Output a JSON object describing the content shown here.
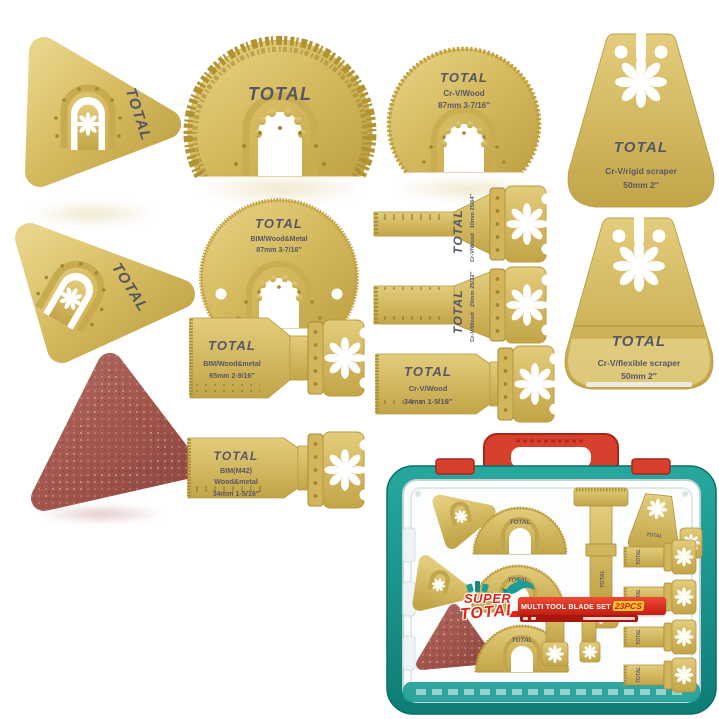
{
  "brand": "TOTAL",
  "background": "#ffffff",
  "palette": {
    "gold": "#d7bc62",
    "gold_dark": "#b89a3e",
    "logo_gray": "#565665",
    "sand_red": "#a3564e",
    "case_teal": "#1b9c94",
    "case_red": "#d8402e",
    "banner_red": "#d6281e",
    "badge_yellow": "#f7c531"
  },
  "items": [
    {
      "id": "triangle-rasp-1",
      "brand": "TOTAL"
    },
    {
      "id": "grit-semicircle-blade",
      "brand": "TOTAL"
    },
    {
      "id": "semicircle-saw-blade",
      "brand": "TOTAL",
      "spec": "Cr-V/Wood",
      "size": "87mm 3-7/16″"
    },
    {
      "id": "rigid-scraper",
      "brand": "TOTAL",
      "spec": "Cr-V/rigid scraper",
      "size": "50mm 2″"
    },
    {
      "id": "triangle-rasp-2",
      "brand": "TOTAL"
    },
    {
      "id": "semicircle-bim-blade",
      "brand": "TOTAL",
      "spec": "BIM/Wood&Metal",
      "size": "87mm 3-7/16″"
    },
    {
      "id": "plunge-blade-10mm",
      "brand": "TOTAL",
      "spec": "Cr-V/Wood",
      "size": "10mm 25/64″"
    },
    {
      "id": "plunge-blade-20mm",
      "brand": "TOTAL",
      "spec": "Cr-V/Wood",
      "size": "20mm 25/32″"
    },
    {
      "id": "flexible-scraper",
      "brand": "TOTAL",
      "spec": "Cr-V/flexible scraper",
      "size": "50mm 2″"
    },
    {
      "id": "plunge-blade-65mm",
      "brand": "TOTAL",
      "spec": "BIM/Wood&metal",
      "size": "65mm 2-9/16″"
    },
    {
      "id": "plunge-blade-34mm-crv",
      "brand": "TOTAL",
      "spec": "Cr-V/Wood",
      "size": "34mm 1-5/16″"
    },
    {
      "id": "plunge-blade-34mm-bim",
      "brand": "TOTAL",
      "spec": "BIM(M42)",
      "spec2": "Wood&metal",
      "size": "34mm 1-5/16″"
    },
    {
      "id": "sanding-pad"
    }
  ],
  "case": {
    "label": {
      "super": "SUPER",
      "total": "TOTAL",
      "banner": "MULTI TOOL BLADE SET",
      "count": "23PCS"
    }
  }
}
